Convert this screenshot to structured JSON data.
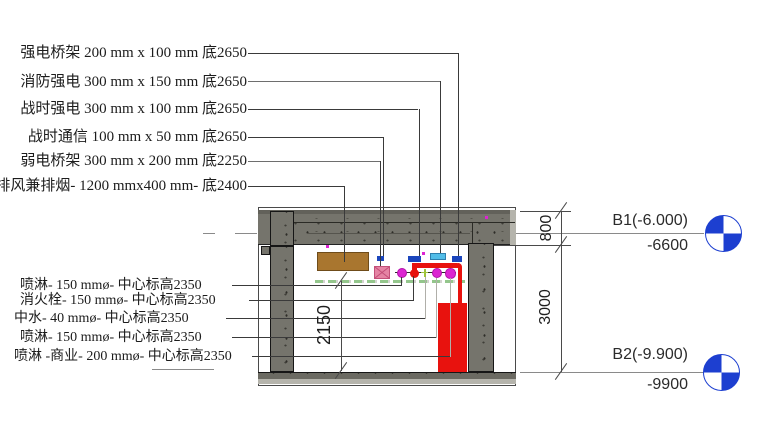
{
  "annotations": {
    "top": [
      {
        "text": "强电桥架 200 mm x 100 mm 底2650"
      },
      {
        "text": "消防强电 300 mm x 150 mm 底2650"
      },
      {
        "text": "战时强电 300 mm x 100 mm 底2650"
      },
      {
        "text": "战时通信 100 mm x 50 mm 底2650"
      },
      {
        "text": "弱电桥架 300 mm x 200 mm 底2250"
      },
      {
        "text": "排风兼排烟- 1200 mmx400 mm- 底2400"
      }
    ],
    "bottom": [
      {
        "text": "喷淋- 150 mmø- 中心标高2350"
      },
      {
        "text": "消火栓- 150 mmø- 中心标高2350"
      },
      {
        "text": "中水- 40 mmø- 中心标高2350"
      },
      {
        "text": "喷淋- 150 mmø- 中心标高2350"
      },
      {
        "text": "喷淋 -商业- 200 mmø- 中心标高2350"
      }
    ]
  },
  "dimensions": {
    "slab_zone": "800",
    "storey": "3000",
    "clear_height": "2150"
  },
  "levels": {
    "b1": {
      "label": "B1(-6.000)",
      "elevation": "-6600"
    },
    "b2": {
      "label": "B2(-9.900)",
      "elevation": "-9900"
    }
  },
  "colors": {
    "concrete": "#75746c",
    "duct_brown": "#a9762f",
    "tray_blue": "#1b46bd",
    "tray_cyan": "#52bde8",
    "tray_pink": "#e584a4",
    "pipe_magenta": "#dc25d2",
    "pipe_red": "#e8120e",
    "centerline_green": "#94c68c",
    "level_blue": "#1d3fd0"
  },
  "icons": {
    "level_head": "level-target-icon"
  }
}
